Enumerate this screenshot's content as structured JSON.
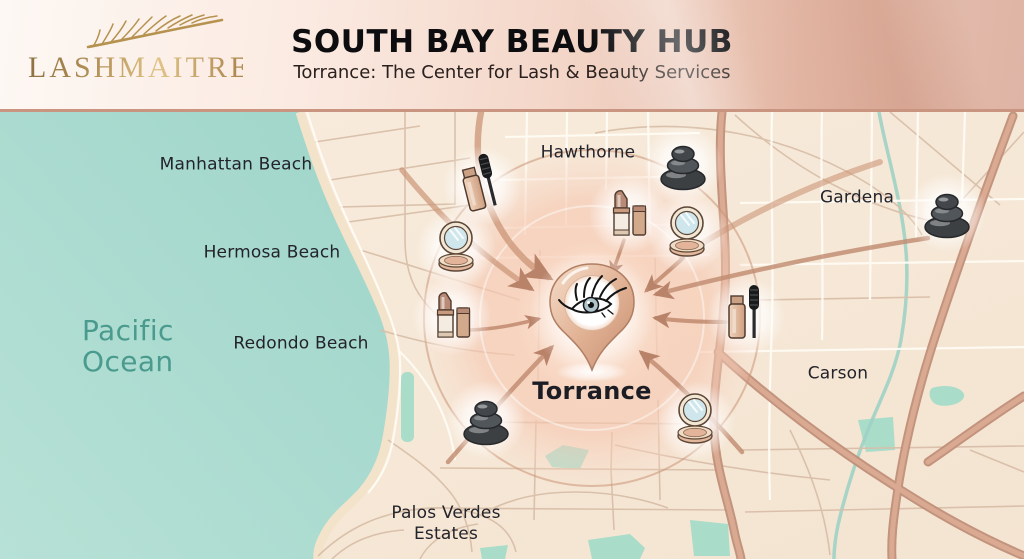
{
  "header": {
    "brand": "LASHMAITRE",
    "title": "SOUTH BAY BEAUTY HUB",
    "subtitle": "Torrance: The Center for Lash & Beauty Services"
  },
  "map": {
    "ocean_label": "Pacific\nOcean",
    "center_label": "Torrance",
    "cities": [
      {
        "id": "manhattan-beach",
        "label": "Manhattan Beach",
        "x": 236,
        "y": 165
      },
      {
        "id": "hermosa-beach",
        "label": "Hermosa Beach",
        "x": 272,
        "y": 253
      },
      {
        "id": "redondo-beach",
        "label": "Redondo Beach",
        "x": 301,
        "y": 344
      },
      {
        "id": "hawthorne",
        "label": "Hawthorne",
        "x": 588,
        "y": 153
      },
      {
        "id": "gardena",
        "label": "Gardena",
        "x": 857,
        "y": 198
      },
      {
        "id": "carson",
        "label": "Carson",
        "x": 838,
        "y": 374
      },
      {
        "id": "palos-verdes-estates",
        "label": "Palos Verdes\nEstates",
        "x": 446,
        "y": 524
      }
    ],
    "icons": [
      {
        "type": "mascara",
        "x": 482,
        "y": 186,
        "rotate": -14
      },
      {
        "type": "compact",
        "x": 456,
        "y": 249,
        "rotate": 0
      },
      {
        "type": "lipstick",
        "x": 452,
        "y": 316,
        "rotate": 0
      },
      {
        "type": "stones",
        "x": 486,
        "y": 420,
        "rotate": 0
      },
      {
        "type": "lipstick",
        "x": 628,
        "y": 214,
        "rotate": 0
      },
      {
        "type": "stones",
        "x": 683,
        "y": 165,
        "rotate": 0
      },
      {
        "type": "compact",
        "x": 687,
        "y": 234,
        "rotate": 0
      },
      {
        "type": "mascara",
        "x": 746,
        "y": 316,
        "rotate": 0
      },
      {
        "type": "stones",
        "x": 947,
        "y": 213,
        "rotate": 0
      },
      {
        "type": "compact",
        "x": 695,
        "y": 421,
        "rotate": 0
      }
    ],
    "colors": {
      "ocean": "#a8dbd1",
      "land": "#f7e9d8",
      "freeway": "#d09a83",
      "arrow": "#bf8a6e",
      "glow": "#f5c9b0",
      "park": "#a9dcc9",
      "gold": "#b5924f",
      "ocean_text": "#4a9a8e",
      "label_text": "#23232b"
    }
  }
}
